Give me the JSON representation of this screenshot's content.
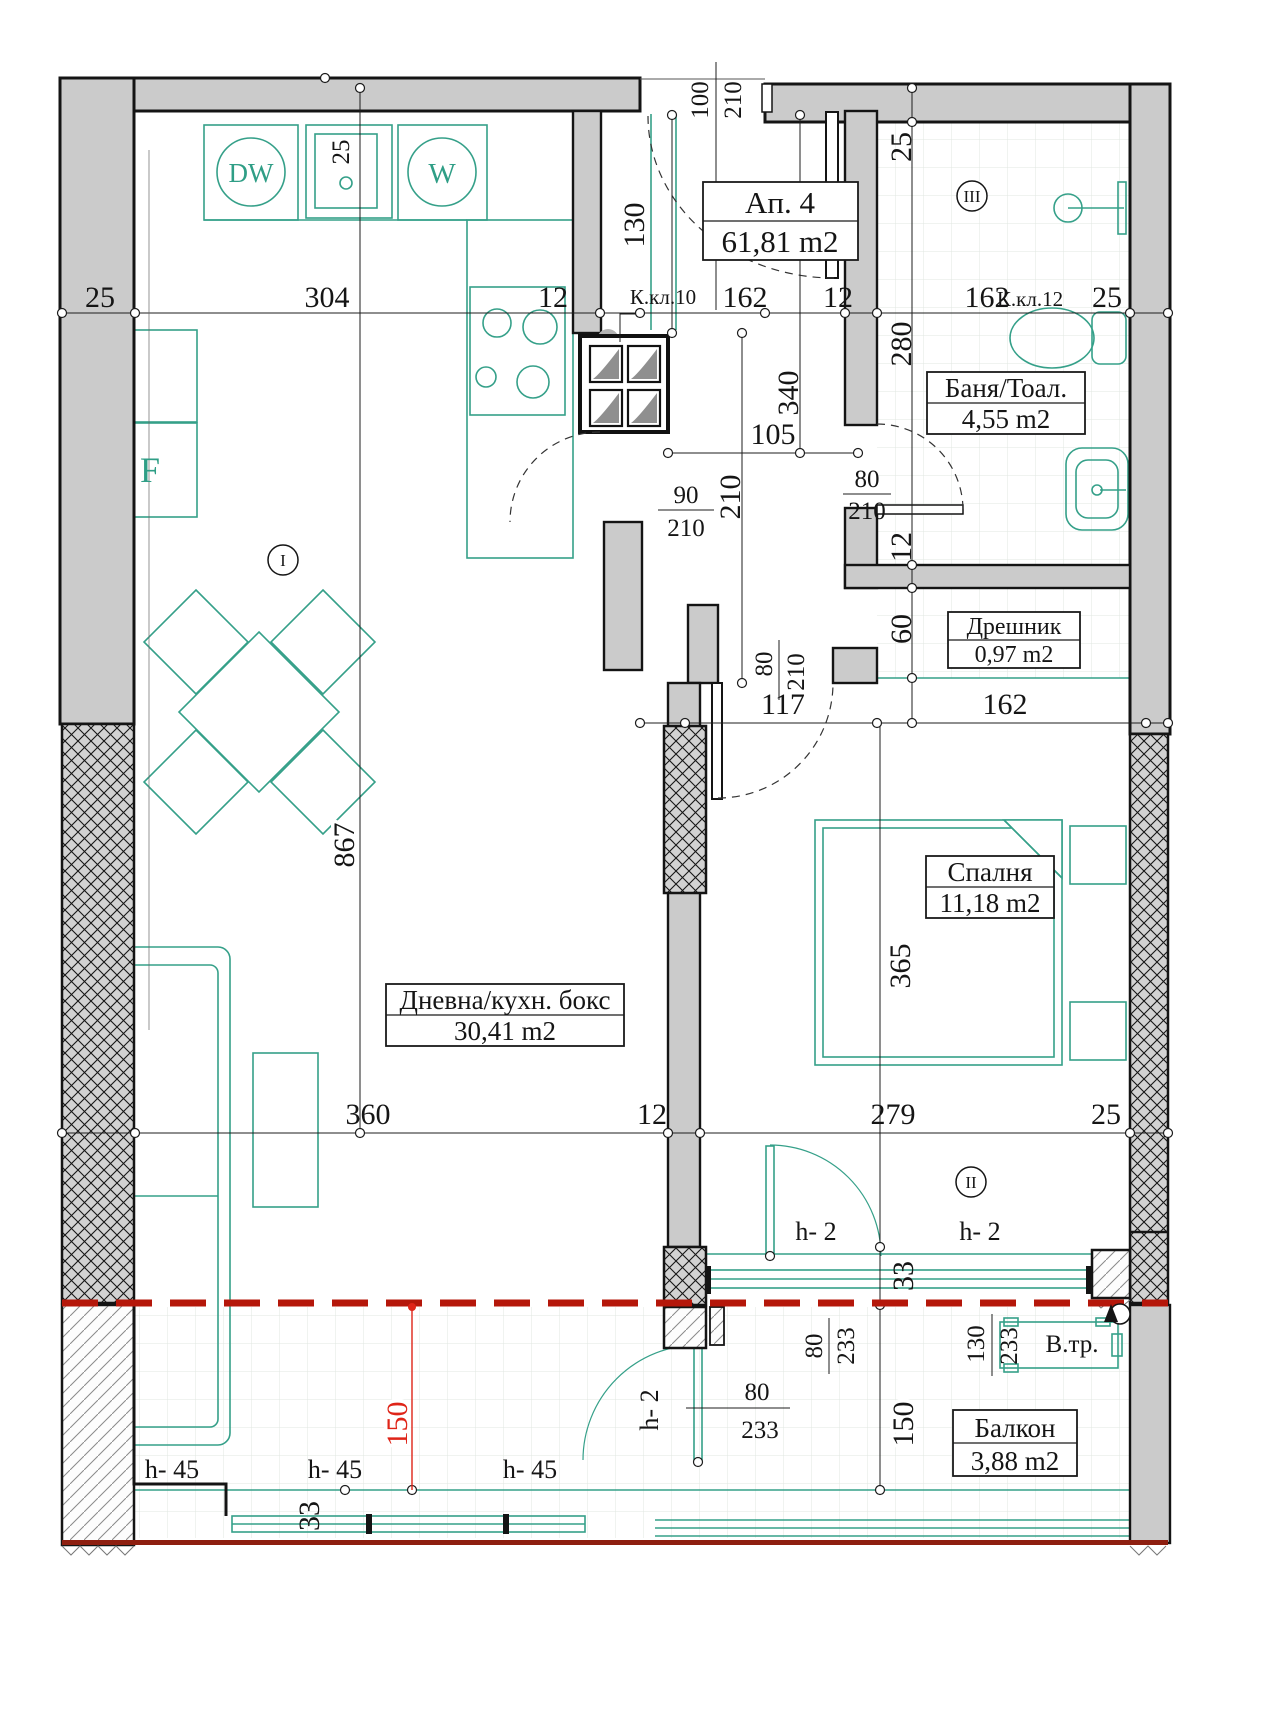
{
  "plan": {
    "apartment": {
      "label": "Ап. 4",
      "area": "61,81 m2"
    },
    "rooms": {
      "living": {
        "name": "Дневна/кухн. бокс",
        "area": "30,41 m2"
      },
      "bath": {
        "name": "Баня/Тоал.",
        "area": "4,55 m2"
      },
      "closet": {
        "name": "Дрешник",
        "area": "0,97 m2"
      },
      "bedroom": {
        "name": "Спалня",
        "area": "11,18 m2"
      },
      "balcony": {
        "name": "Балкон",
        "area": "3,88 m2"
      }
    },
    "markers": {
      "living": "I",
      "balcony": "II",
      "bath": "III"
    },
    "fixtures": {
      "dishwasher": "DW",
      "washer": "W",
      "fridge": "F",
      "vent_pipe": "В.тр."
    },
    "shafts": {
      "k10": "К.кл.10",
      "k12": "К.кл.12"
    },
    "dims": {
      "top": {
        "wall_left": "25",
        "kitchen": "304",
        "jamb": "12",
        "hall": "162",
        "jamb2": "12",
        "bath": "162",
        "wall_right": "25"
      },
      "entry_door": {
        "w": "100",
        "h": "210"
      },
      "hall_front": "130",
      "hall_width": "105",
      "hall_length": "340",
      "hall_length2": "210",
      "kitchen_door": {
        "w": "90",
        "h": "210"
      },
      "bath_door": {
        "w": "80",
        "h": "210"
      },
      "right": {
        "wall": "25",
        "bath": "280",
        "jamb": "12",
        "closet": "60"
      },
      "mid": {
        "hall": "117",
        "closet": "162"
      },
      "bedroom_door": {
        "w": "80",
        "h": "210"
      },
      "bedroom_length": "365",
      "living_length": "867",
      "sink": "25",
      "bottom": {
        "living": "360",
        "wall": "12",
        "bedroom": "279",
        "wall_right": "25"
      },
      "sill_height": "33",
      "bedroom_balcony_door": {
        "w": "80",
        "h": "233"
      },
      "bedroom_window": {
        "w": "130",
        "h": "233"
      },
      "living_balcony_door": {
        "w": "80",
        "h": "233"
      },
      "balcony_depth": "150",
      "balcony_depth_red": "150",
      "parapet_low": "h- 2",
      "parapet_high": "h- 45"
    }
  }
}
